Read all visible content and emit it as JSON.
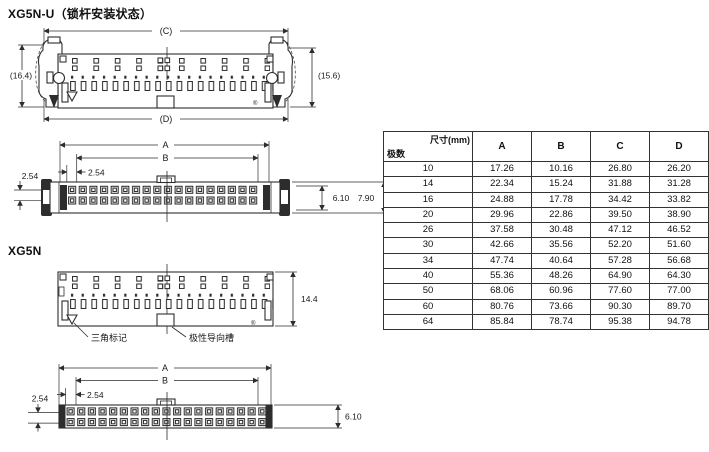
{
  "titles": {
    "xg5n_u": "XG5N-U（锁杆安装状态）",
    "xg5n": "XG5N"
  },
  "front_u": {
    "dim_c": "(C)",
    "dim_d": "(D)",
    "dim_left": "(16.4)",
    "dim_right": "(15.6)",
    "reg_mark": "®"
  },
  "bottom_u": {
    "dim_a": "A",
    "dim_b": "B",
    "pitch_h": "2.54",
    "pitch_v": "2.54",
    "dim_inner": "6.10",
    "dim_outer": "7.90"
  },
  "front_n": {
    "dim_height": "14.4",
    "label_triangle": "三角标记",
    "label_polarity": "极性导向槽",
    "reg_mark": "®"
  },
  "bottom_n": {
    "dim_a": "A",
    "dim_b": "B",
    "pitch_h": "2.54",
    "pitch_v": "2.54",
    "dim_height": "6.10"
  },
  "table": {
    "corner_top": "尺寸(mm)",
    "corner_bottom": "极数",
    "columns": [
      "A",
      "B",
      "C",
      "D"
    ],
    "rows": [
      [
        "10",
        "17.26",
        "10.16",
        "26.80",
        "26.20"
      ],
      [
        "14",
        "22.34",
        "15.24",
        "31.88",
        "31.28"
      ],
      [
        "16",
        "24.88",
        "17.78",
        "34.42",
        "33.82"
      ],
      [
        "20",
        "29.96",
        "22.86",
        "39.50",
        "38.90"
      ],
      [
        "26",
        "37.58",
        "30.48",
        "47.12",
        "46.52"
      ],
      [
        "30",
        "42.66",
        "35.56",
        "52.20",
        "51.60"
      ],
      [
        "34",
        "47.74",
        "40.64",
        "57.28",
        "56.68"
      ],
      [
        "40",
        "55.36",
        "48.26",
        "64.90",
        "64.30"
      ],
      [
        "50",
        "68.06",
        "60.96",
        "77.60",
        "77.00"
      ],
      [
        "60",
        "80.76",
        "73.66",
        "90.30",
        "89.70"
      ],
      [
        "64",
        "85.84",
        "78.74",
        "95.38",
        "94.78"
      ]
    ]
  }
}
